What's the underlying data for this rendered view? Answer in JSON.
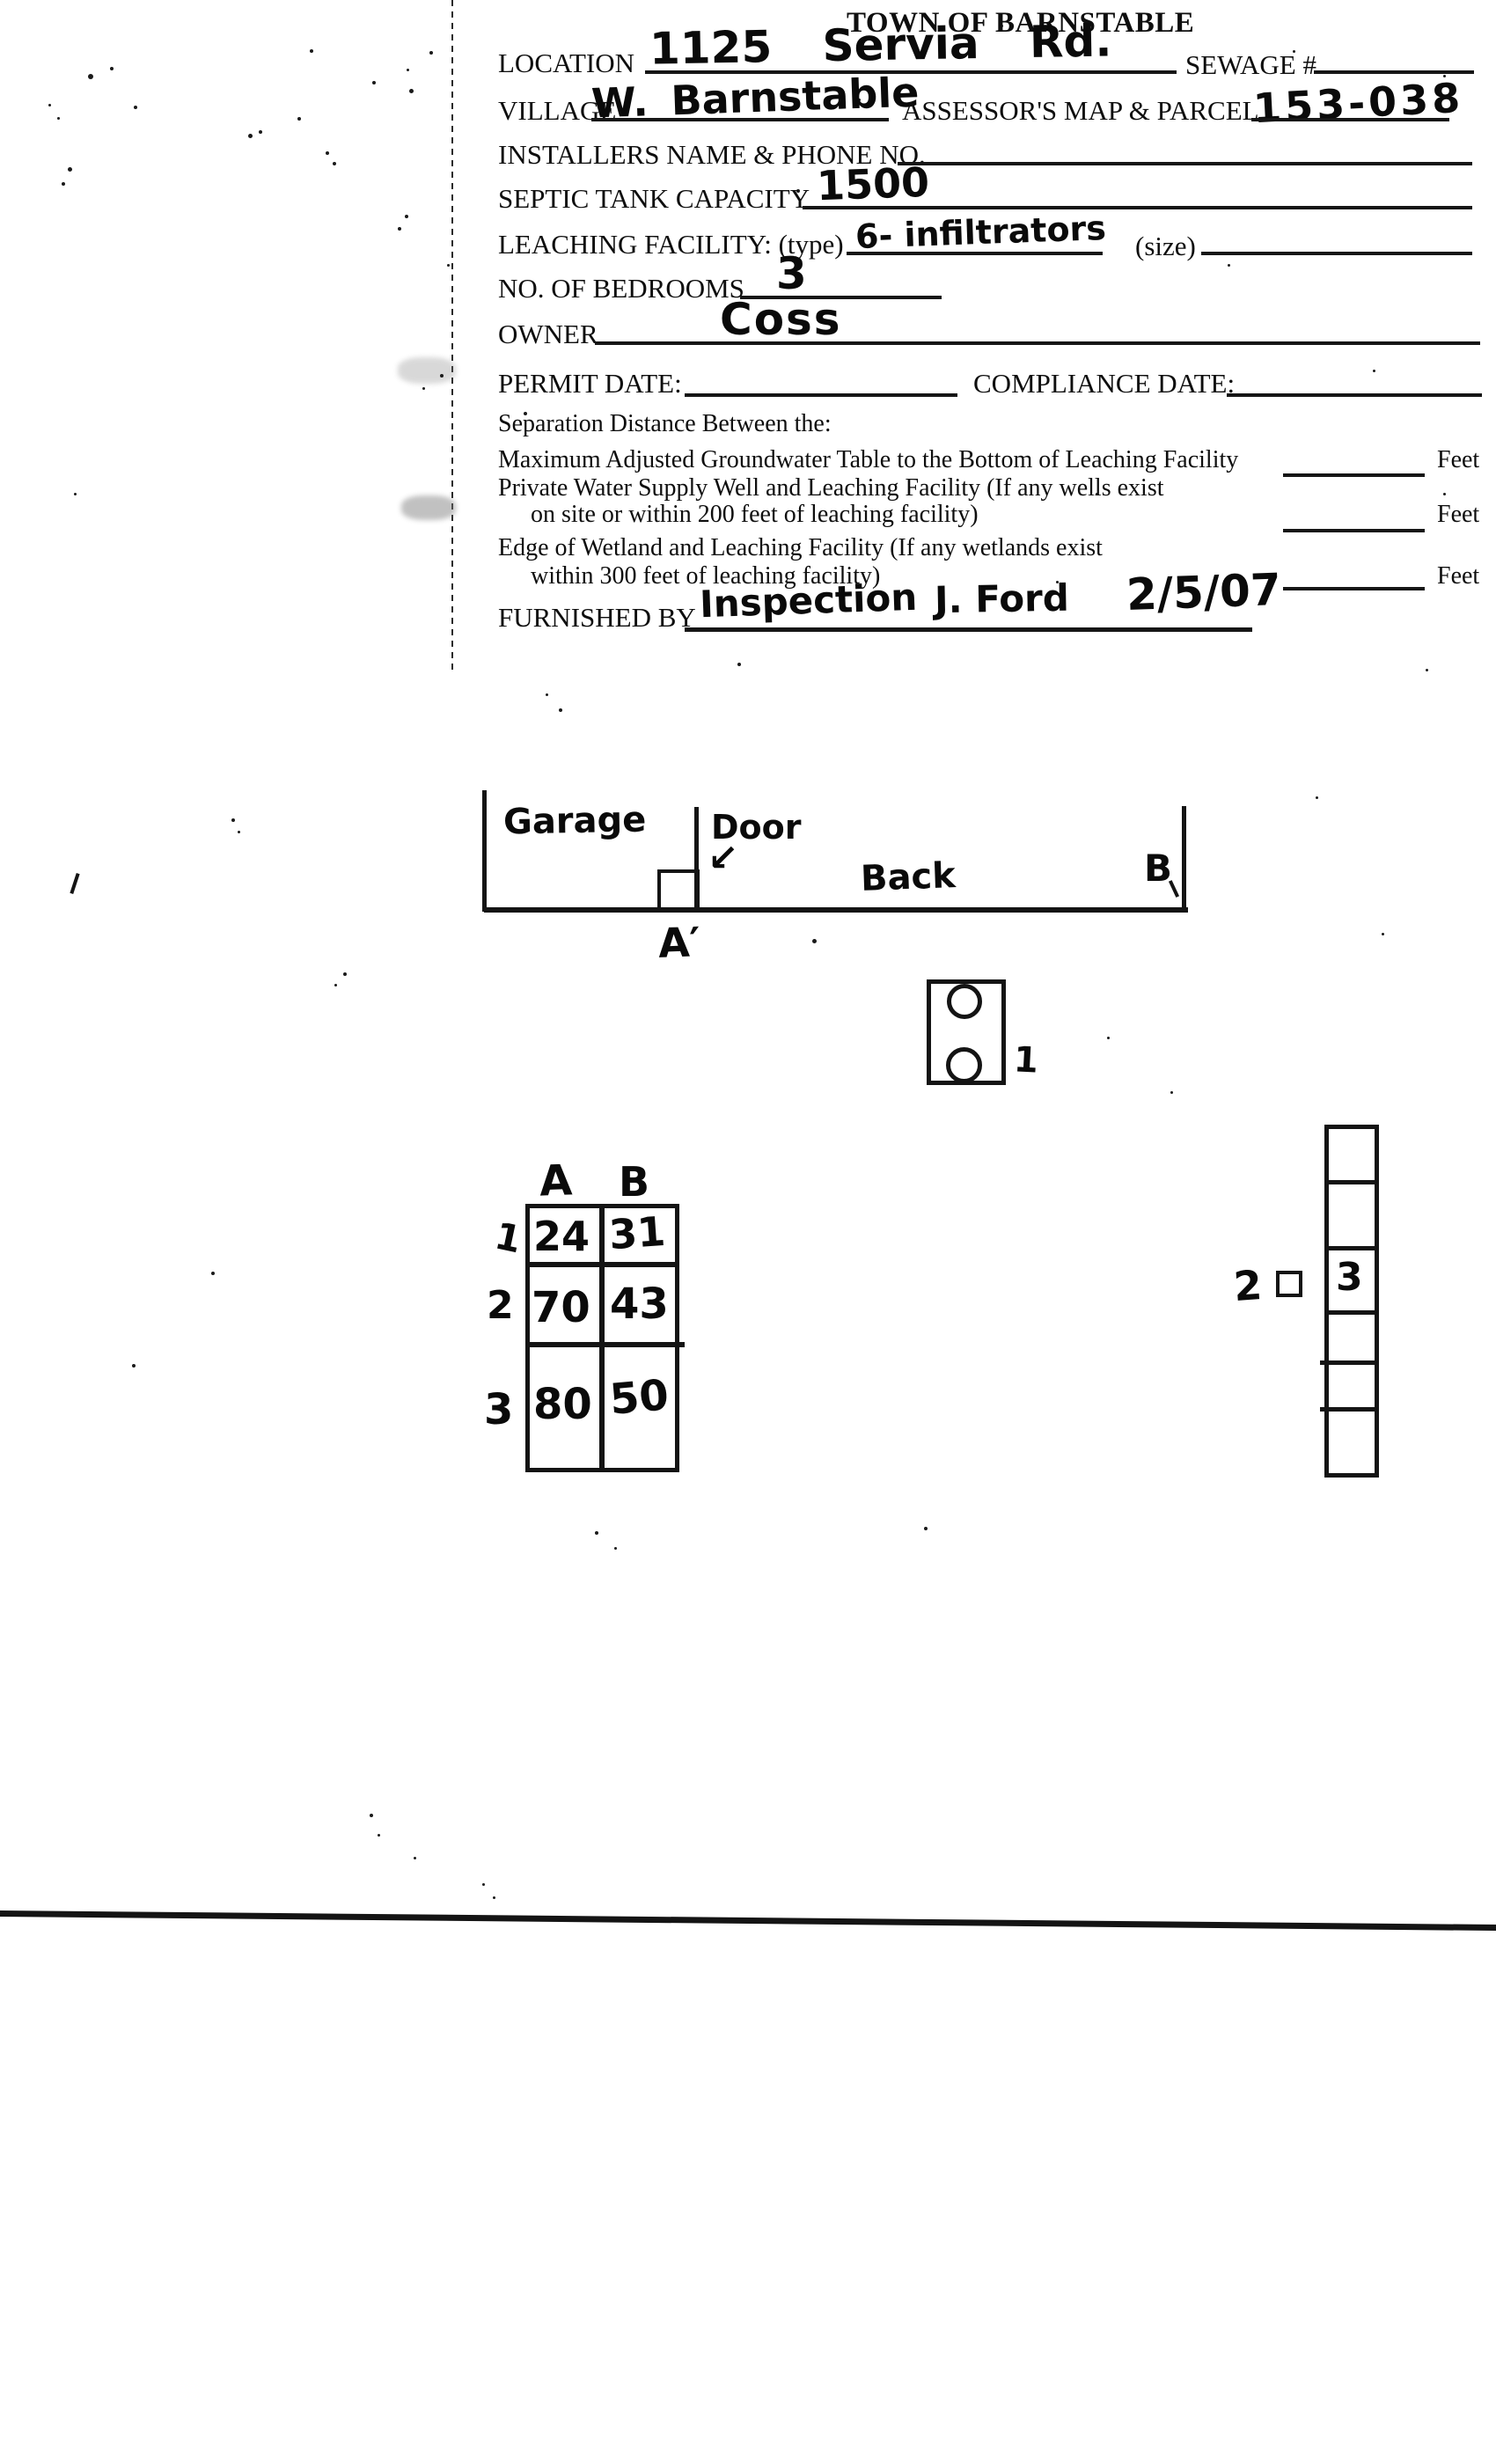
{
  "page": {
    "title": "TOWN OF BARNSTABLE"
  },
  "form": {
    "labels": {
      "location": "LOCATION",
      "sewage": "SEWAGE #",
      "village": "VILLAGE",
      "assessors_map_parcel": "ASSESSOR'S MAP & PARCEL",
      "installers": "INSTALLERS NAME & PHONE NO.",
      "septic_capacity": "SEPTIC TANK CAPACITY",
      "leaching_facility": "LEACHING FACILITY: (type)",
      "size": "(size)",
      "bedrooms": "NO. OF BEDROOMS",
      "owner": "OWNER",
      "permit_date": "PERMIT DATE:",
      "compliance_date": "COMPLIANCE DATE:",
      "separation_heading": "Separation Distance Between the:",
      "groundwater": "Maximum Adjusted Groundwater Table to the Bottom of Leaching Facility",
      "well_1": "Private Water Supply Well and Leaching Facility (If any wells exist",
      "well_2": "on site or within 200 feet of leaching facility)",
      "wetland_1": "Edge of Wetland and Leaching Facility (If any wetlands exist",
      "wetland_2": "within 300 feet of leaching facility)",
      "feet": "Feet",
      "furnished_by": "FURNISHED BY"
    },
    "entries": {
      "location": "1125 Servia Rd.",
      "village": "W. Barnstable",
      "assessors_map_parcel": "153-038",
      "septic_capacity": "1500",
      "leaching_type": "6- infiltrators",
      "bedrooms": "3",
      "owner": "Coss",
      "furnished_by_1": "Inspection",
      "furnished_by_2": "J. Ford",
      "furnished_by_3": "2/5/07"
    }
  },
  "sketch": {
    "garage": "Garage",
    "door": "Door",
    "door_arrow": "↙",
    "back": "Back",
    "corner_b": "B",
    "corner_a": "A′",
    "tank_mark": "1",
    "stack_left_number": "2",
    "stack_cell_number": "3"
  },
  "measure_table": {
    "col_headers": [
      "A",
      "B"
    ],
    "row_labels": [
      "1",
      "2",
      "3"
    ],
    "rows": [
      [
        "24",
        "31"
      ],
      [
        "70",
        "43"
      ],
      [
        "80",
        "50"
      ]
    ]
  }
}
